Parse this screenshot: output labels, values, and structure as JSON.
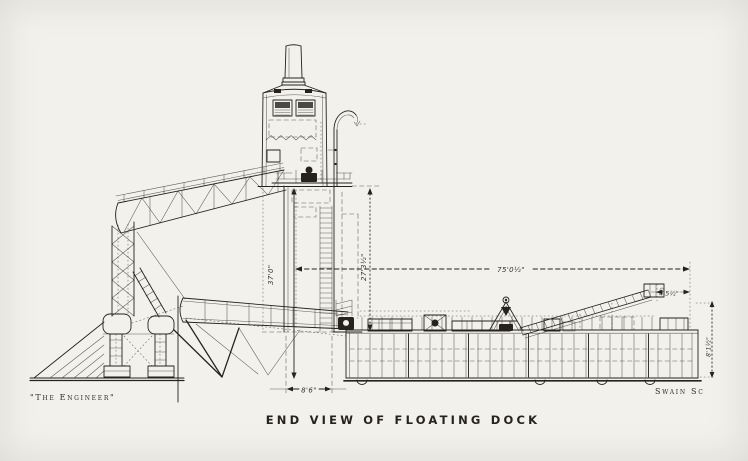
{
  "colors": {
    "paper": "#f2f1ec",
    "ink": "#26231e"
  },
  "caption": "END VIEW OF FLOATING DOCK",
  "credits": {
    "publisher": "\"The Engineer\"",
    "engraver": "Swain Sc"
  },
  "dimensions": {
    "beam_overall": "75'0½\"",
    "height_left": "37'0\"",
    "height_right": "27'3½\"",
    "well_width": "8'6\"",
    "ramp_height": "4'5½\"",
    "depth_right": "8'1½\""
  }
}
